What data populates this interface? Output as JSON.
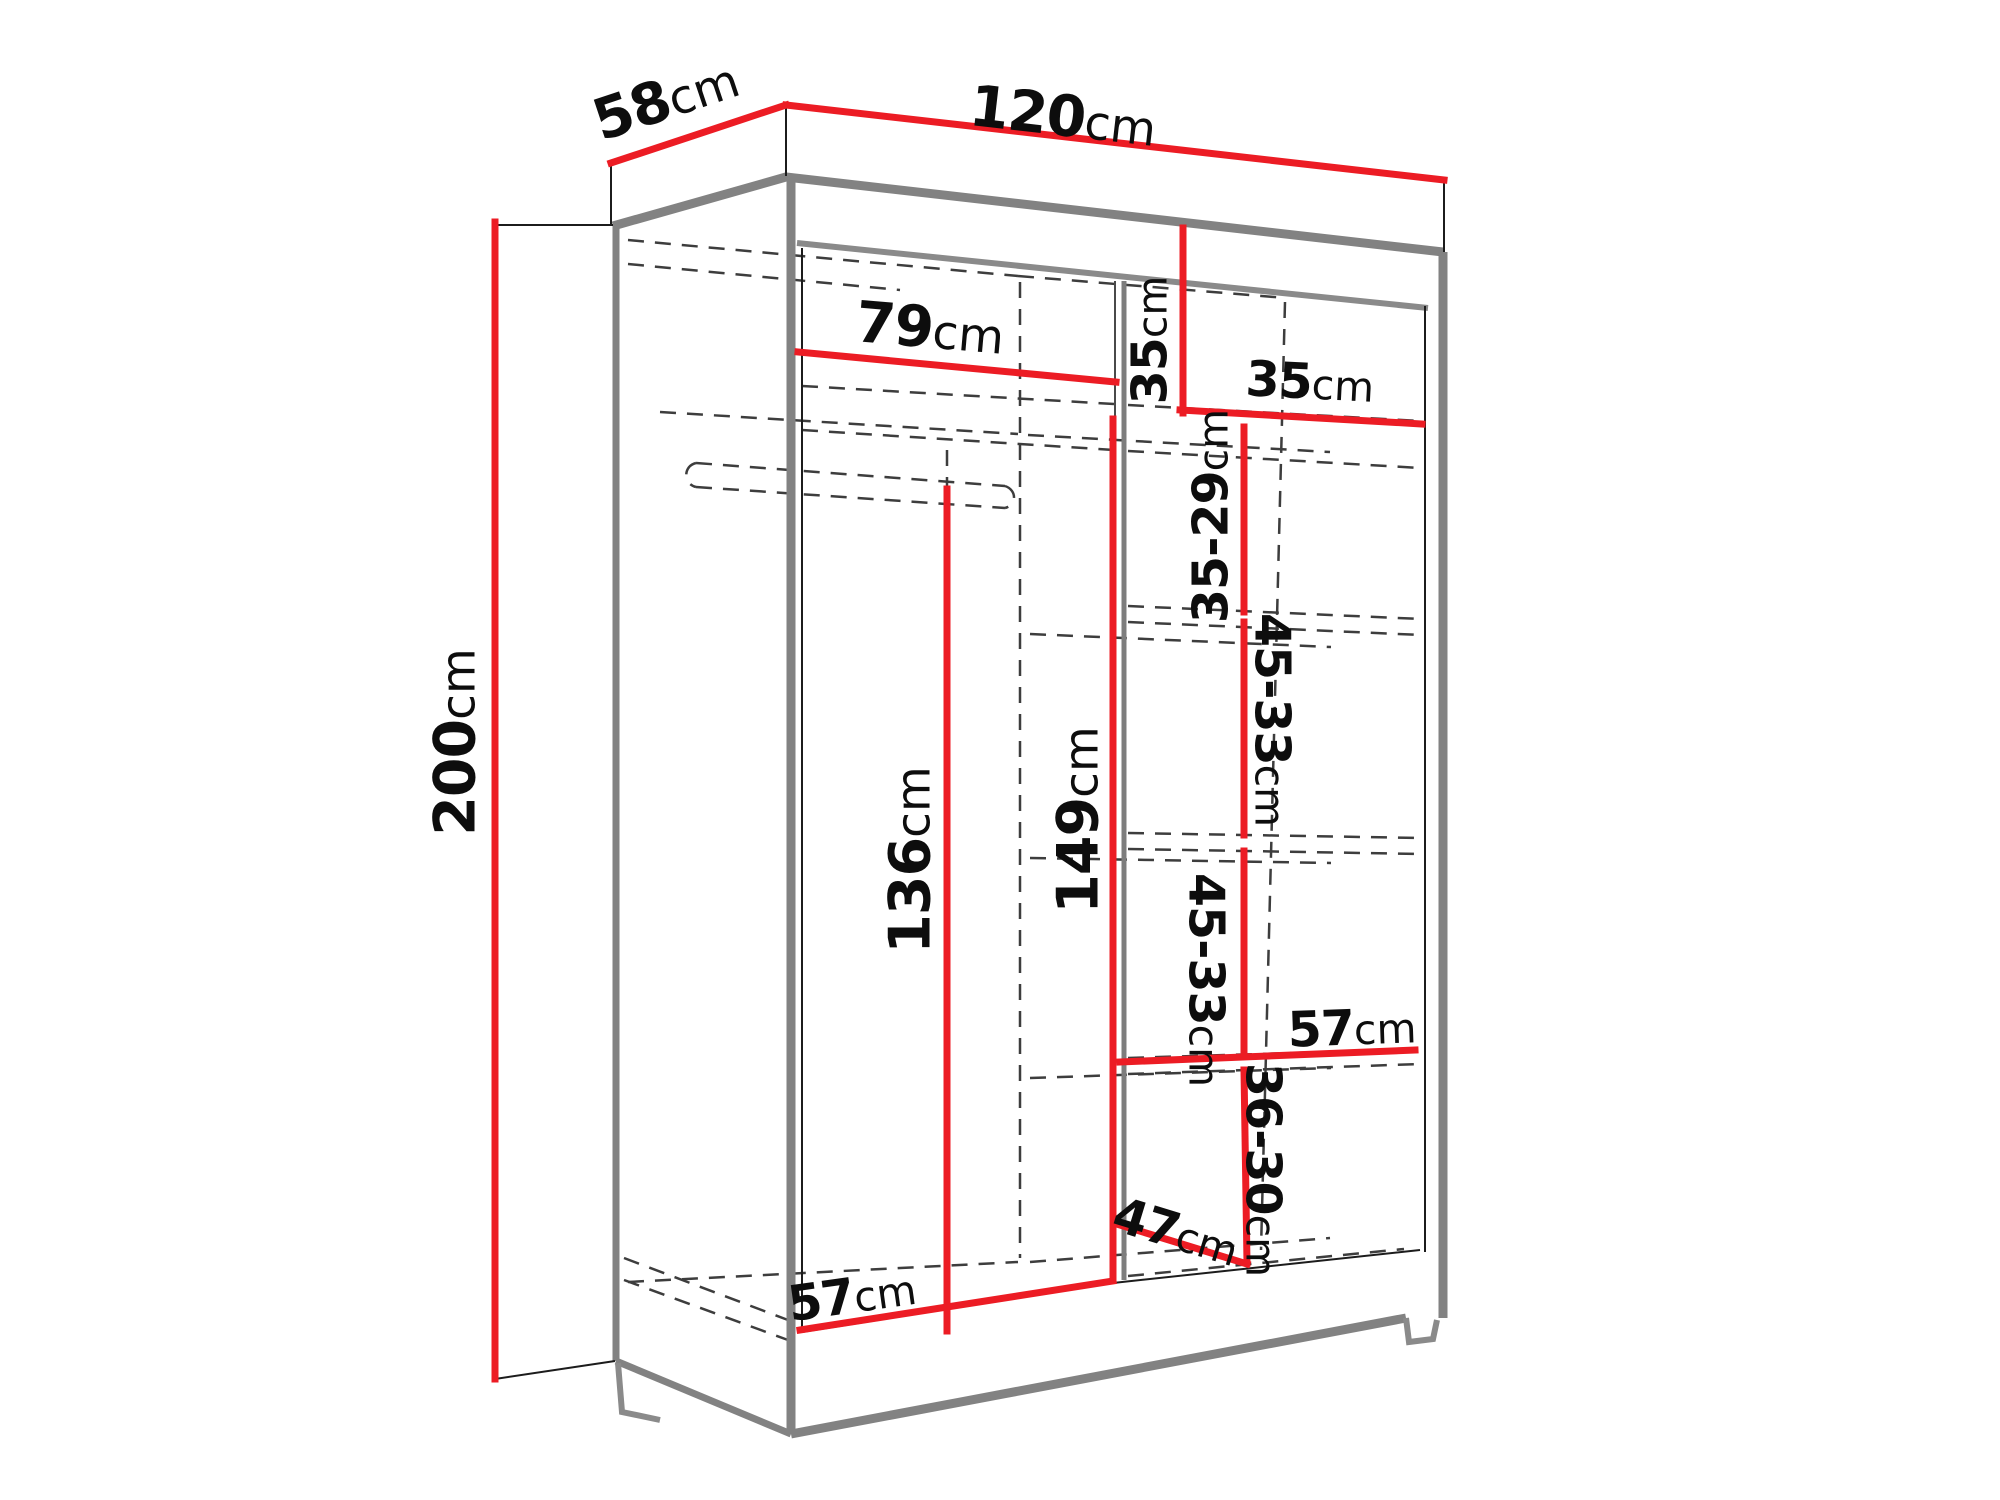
{
  "diagram": {
    "kind": "wardrobe-dimension-drawing",
    "unit": "cm",
    "colors": {
      "dimension_line": "#ec1c24",
      "cabinet_edge": "#828282",
      "hidden_line": "#3d3d3d",
      "text": "#0d0d0d",
      "background": "#ffffff"
    },
    "dims": {
      "depth": {
        "v": "58",
        "u": "cm"
      },
      "width": {
        "v": "120",
        "u": "cm"
      },
      "height": {
        "v": "200",
        "u": "cm"
      },
      "top_shelf_width": {
        "v": "79",
        "u": "cm"
      },
      "top_right_height": {
        "v": "35",
        "u": "cm"
      },
      "top_right_width": {
        "v": "35",
        "u": "cm"
      },
      "shelf_gap_upper": {
        "v": "35-29",
        "u": "cm"
      },
      "shelf_gap_mid": {
        "v": "45-33",
        "u": "cm"
      },
      "shelf_gap_lower": {
        "v": "45-33",
        "u": "cm"
      },
      "hanging_height": {
        "v": "136",
        "u": "cm"
      },
      "partition_height": {
        "v": "149",
        "u": "cm"
      },
      "shelf_width_right": {
        "v": "57",
        "u": "cm"
      },
      "drawer_gap": {
        "v": "36-30",
        "u": "cm"
      },
      "drawer_depth": {
        "v": "47",
        "u": "cm"
      },
      "floor_width_left": {
        "v": "57",
        "u": "cm"
      }
    }
  }
}
